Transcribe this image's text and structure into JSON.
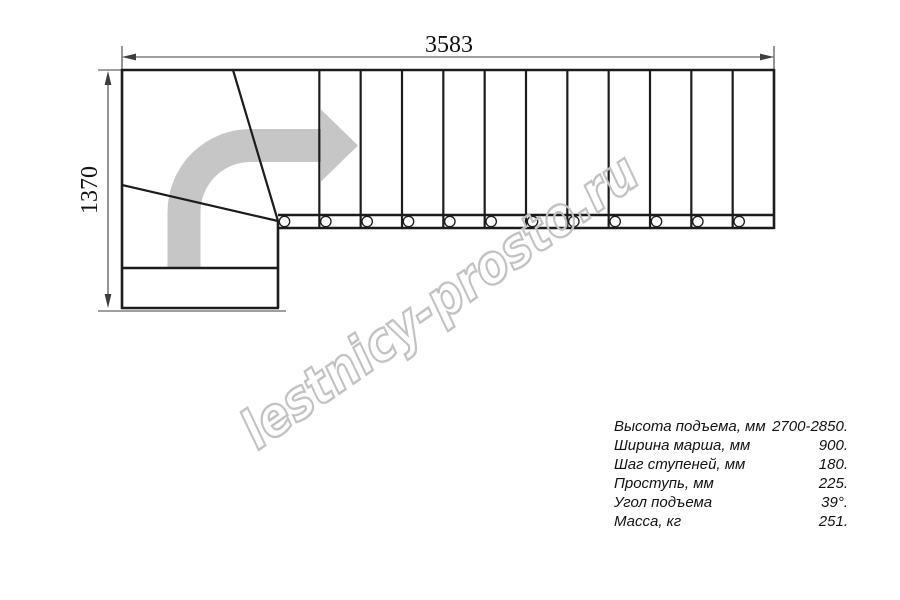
{
  "drawing": {
    "type": "stair-plan-L-shaped",
    "dimensions": {
      "top_width": "3583",
      "left_depth": "1370"
    },
    "watermark": "lestnicy-prosto.ru",
    "straight_flight": {
      "steps": 12
    },
    "colors": {
      "outline": "#1c1c1c",
      "dimension": "#3d3d3d",
      "arrow": "#c6c6c6",
      "watermark_outline": "#c2c2c2",
      "background": "#ffffff"
    }
  },
  "specs": {
    "rows": [
      {
        "label": "Высота подъема, мм",
        "value": "2700-2850."
      },
      {
        "label": "Ширина марша, мм",
        "value": "900."
      },
      {
        "label": "Шаг ступеней, мм",
        "value": "180."
      },
      {
        "label": "Проступь, мм",
        "value": "225."
      },
      {
        "label": "Угол подъема",
        "value": "39°."
      },
      {
        "label": "Масса, кг",
        "value": "251."
      }
    ]
  }
}
